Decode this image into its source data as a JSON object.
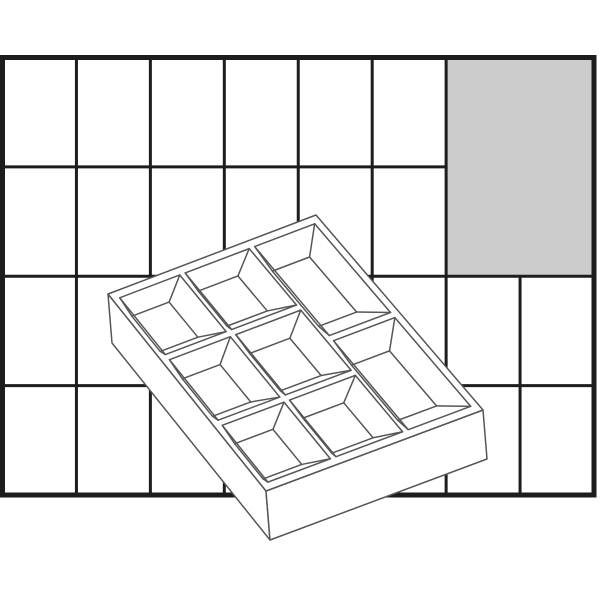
{
  "scene": {
    "width": 600,
    "height": 600,
    "background": "#ffffff",
    "description": "Line drawing of a storage box insert tray with 8 compartments on black grid paper; a 2x2-cell block at top right is shaded gray"
  },
  "grid": {
    "x": 2.5,
    "y": 57.5,
    "width": 591.5,
    "height": 437.5,
    "columns": 8,
    "rows": 4,
    "line_color": "#1d1d1d",
    "outer_stroke_px": 5,
    "inner_stroke_px": 3,
    "paper_fill": "#ffffff",
    "shaded_block": {
      "col_start": 6,
      "row_start": 0,
      "col_span": 2,
      "row_span": 2,
      "fill": "#cccccc"
    }
  },
  "tray": {
    "stroke_color": "#565656",
    "stroke_px": 1.5,
    "fill": "#ffffff",
    "rim_quad": {
      "left": [
        108,
        294
      ],
      "top": [
        316,
        215
      ],
      "right": [
        483,
        410
      ],
      "bottom": [
        266,
        491
      ]
    },
    "depth_offset": [
      4,
      49
    ],
    "edge_margin": 0.032,
    "divider_gap": 0.013,
    "floor_scale": 0.62,
    "floor_offset": [
      -8,
      12
    ],
    "compartment_count": 8,
    "compartments": [
      {
        "a0": 0.0,
        "b0": 0.0,
        "a1": 0.3333,
        "b1": 0.3333
      },
      {
        "a0": 0.3333,
        "b0": 0.0,
        "a1": 0.6667,
        "b1": 0.3333
      },
      {
        "a0": 0.6667,
        "b0": 0.0,
        "a1": 1.0,
        "b1": 0.5
      },
      {
        "a0": 0.0,
        "b0": 0.3333,
        "a1": 0.3333,
        "b1": 0.6667
      },
      {
        "a0": 0.3333,
        "b0": 0.3333,
        "a1": 0.6667,
        "b1": 0.6667
      },
      {
        "a0": 0.6667,
        "b0": 0.5,
        "a1": 1.0,
        "b1": 1.0
      },
      {
        "a0": 0.0,
        "b0": 0.6667,
        "a1": 0.3333,
        "b1": 1.0
      },
      {
        "a0": 0.3333,
        "b0": 0.6667,
        "a1": 0.6667,
        "b1": 1.0
      }
    ]
  }
}
